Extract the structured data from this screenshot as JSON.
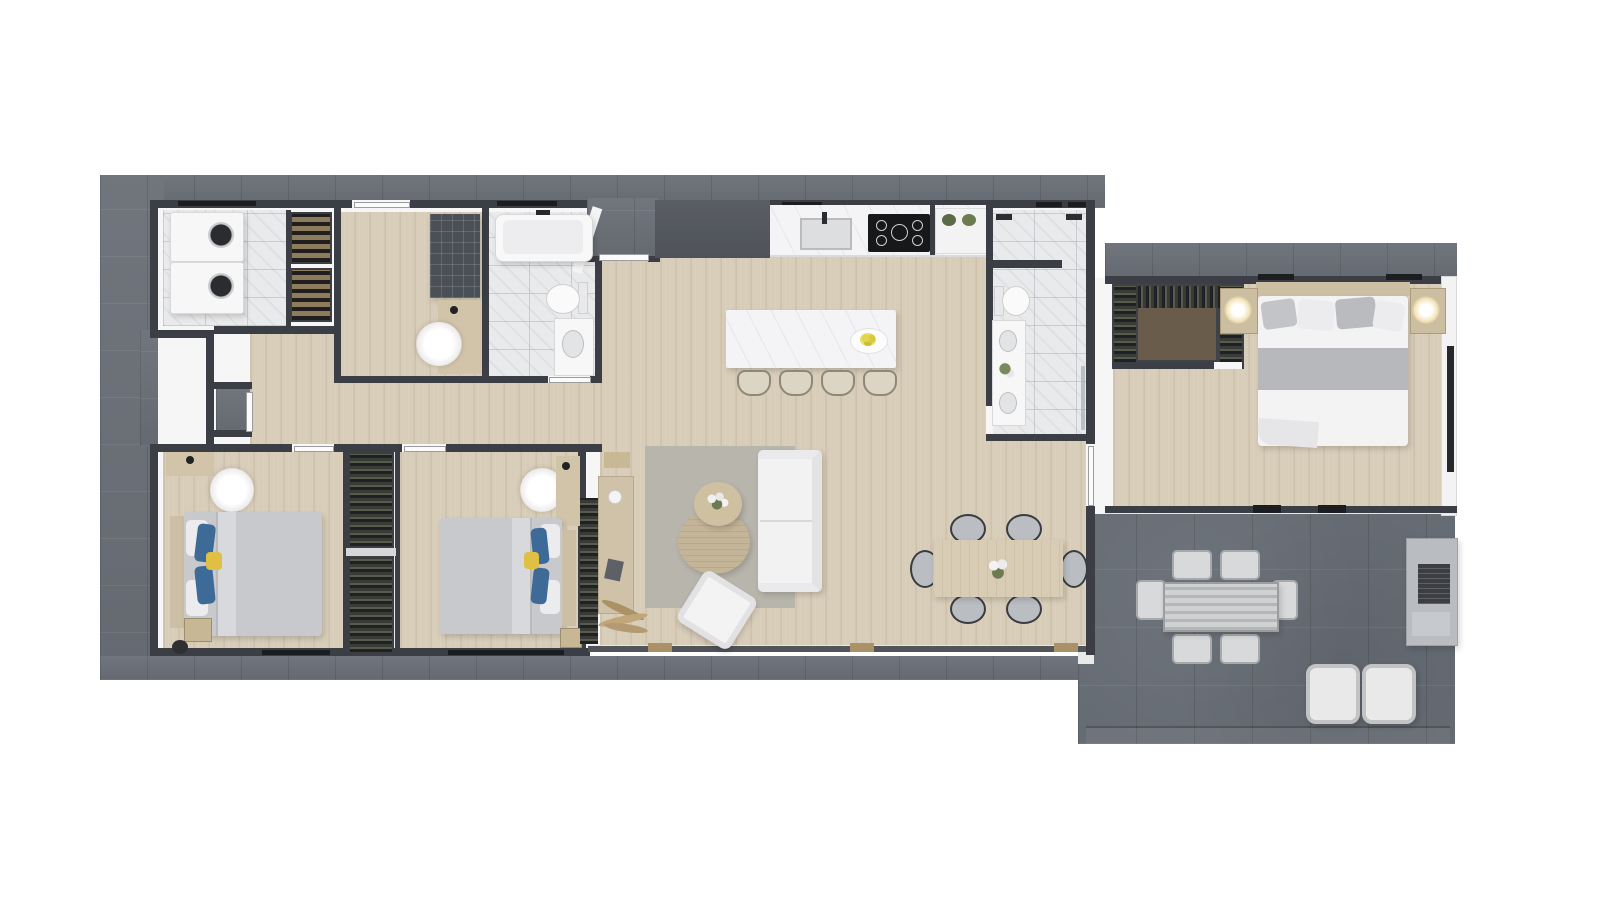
{
  "scene": {
    "kind": "3d-rendered-floor-plan",
    "view": "top-down",
    "page_background": "#ffffff",
    "has_text_labels": false
  },
  "palette": {
    "exterior_stone": "#6b7078",
    "patio_stone": "#666c74",
    "wall_dark": "#3b3e44",
    "interior_white": "#f6f6f7",
    "wood_floor": "#d8cdb9",
    "marble_tile": "#e9eaec",
    "counter_marble": "#f4f4f6",
    "dark_cabinet": "#54575e",
    "cooktop_black": "#17181a",
    "rug_gray": "#b8b6ac",
    "upholstery_white": "#f2f2f3",
    "table_wood": "#d9ccb5",
    "duvet_gray": "#c8c9cc",
    "duvet_white": "#f3f3f4",
    "blanket_stripe_gray": "#b6b8bc",
    "pillow_blue": "#3e6a98",
    "pillow_yellow": "#e0bf45",
    "headboard_tan": "#cdbfa4",
    "wine_shelf_tan": "#8d7c5c",
    "closet_dark": "#3f4248",
    "lamp_glow": "#f3e3b6",
    "plant_green": "#5a6b46",
    "lemon_yellow": "#d8c93e",
    "bbq_concrete": "#b9bcc0"
  },
  "rooms": [
    {
      "name": "laundry-room",
      "floor": "marble",
      "contents": [
        "washer",
        "dryer"
      ]
    },
    {
      "name": "wine-pantry",
      "floor": "white",
      "contents": [
        "wine-rack-upper",
        "wine-rack-lower"
      ]
    },
    {
      "name": "office-mudroom",
      "floor": "wood",
      "contents": [
        "cubby-cabinet",
        "desk",
        "desk-lamp",
        "fluffy-chair"
      ]
    },
    {
      "name": "bathroom-1",
      "floor": "marble",
      "contents": [
        "bathtub",
        "toilet",
        "vanity-sink"
      ]
    },
    {
      "name": "entry-porch",
      "floor": "stone",
      "contents": [
        "front-door"
      ]
    },
    {
      "name": "side-entry-nook",
      "floor": "stone",
      "contents": [
        "side-door"
      ]
    },
    {
      "name": "kitchen",
      "floor": "wood",
      "contents": [
        "tall-dark-cabinets",
        "counter-with-sink",
        "cooktop-5-burner",
        "open-shelf-plants",
        "island",
        "bar-stools-x4",
        "plate-of-lemons"
      ]
    },
    {
      "name": "master-bathroom",
      "floor": "marble",
      "contents": [
        "walk-in-shower",
        "dual-shower-heads",
        "toilet",
        "double-vanity",
        "flowers",
        "glass-partition"
      ]
    },
    {
      "name": "hallway",
      "floor": "wood",
      "contents": [
        "bench"
      ]
    },
    {
      "name": "bedroom-1",
      "floor": "wood",
      "contents": [
        "double-bed-gray-duvet",
        "blue-pillows-x2",
        "yellow-pillow",
        "headboard",
        "desk",
        "desk-lamp",
        "fluffy-chair",
        "nightstand-books",
        "black-stool"
      ]
    },
    {
      "name": "shared-closet",
      "floor": "white",
      "contents": [
        "wardrobe-upper",
        "wardrobe-lower"
      ]
    },
    {
      "name": "bedroom-2",
      "floor": "wood",
      "contents": [
        "double-bed-gray-duvet",
        "blue-pillows-x2",
        "yellow-pillow",
        "headboard",
        "desk",
        "desk-lamp",
        "fluffy-chair",
        "side-wardrobe"
      ]
    },
    {
      "name": "living-room",
      "floor": "wood",
      "contents": [
        "area-rug",
        "sofa-white",
        "armchair-white",
        "coffee-table-large",
        "coffee-table-small-with-flowers",
        "sideboard",
        "dried-plant"
      ]
    },
    {
      "name": "dining-area",
      "floor": "wood",
      "contents": [
        "dining-table",
        "dining-chairs-x6",
        "flower-centerpiece"
      ]
    },
    {
      "name": "master-bedroom",
      "floor": "wood",
      "contents": [
        "walk-in-closet",
        "king-bed-white-duvet-gray-stripe",
        "pillows",
        "nightstand-x2",
        "glowing-lamp-x2",
        "window-panel"
      ]
    },
    {
      "name": "patio",
      "floor": "stone",
      "contents": [
        "outdoor-table-slatted",
        "outdoor-chairs-x6",
        "lounge-chairs-x2",
        "bbq-island"
      ]
    }
  ],
  "counts": {
    "bedrooms": 3,
    "bathrooms": 2,
    "bar_stools": 4,
    "dining_chairs": 6,
    "outdoor_chairs": 6,
    "lounge_chairs": 2,
    "beds": 3
  }
}
